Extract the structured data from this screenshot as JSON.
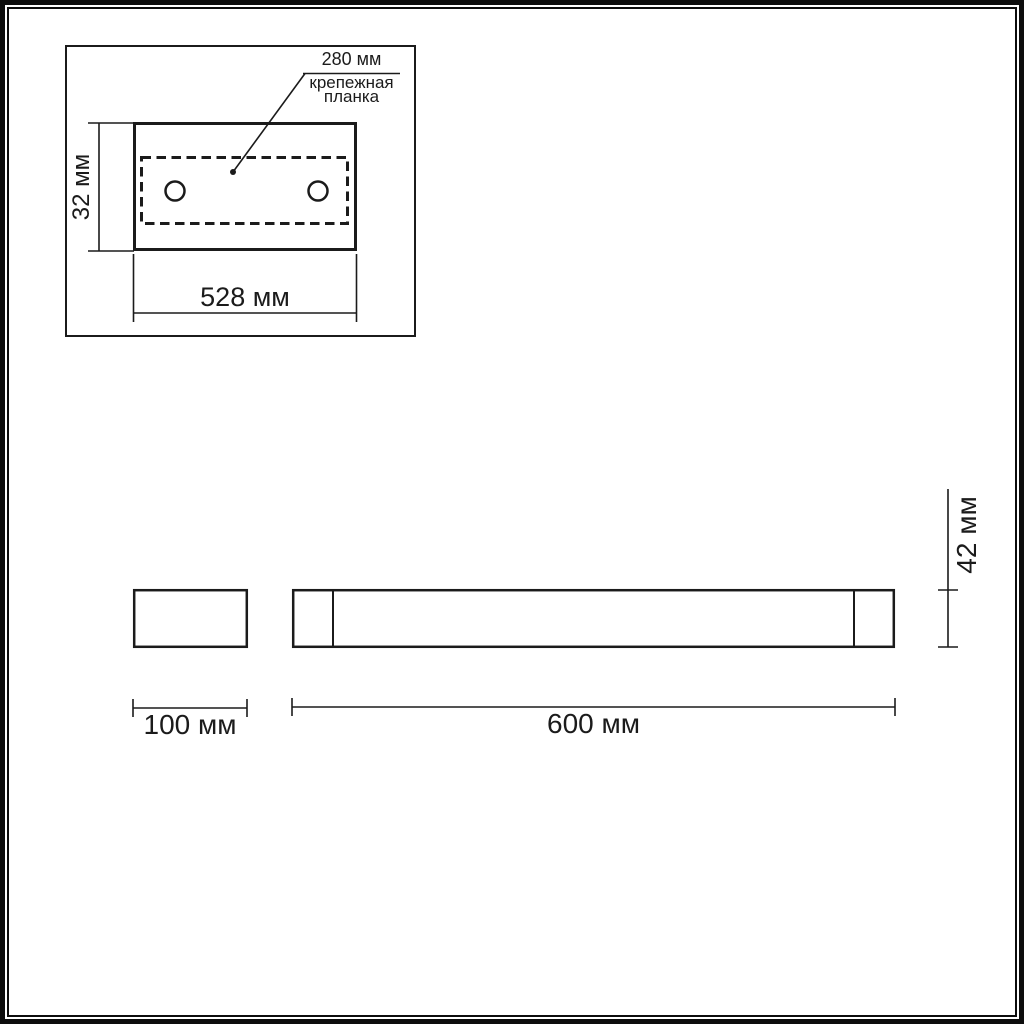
{
  "drawing": {
    "kind": "luminaire-dimension-drawing",
    "units": "мм",
    "line_color": "#1b1b1b",
    "background_color": "#ffffff",
    "top_view": {
      "bracket_length_label": "280 мм",
      "bracket_name_label": "крепежная\nпланка",
      "plate_height_label": "32 мм",
      "plate_width_label": "528 мм",
      "hole_count": 2
    },
    "front_view": {
      "length_label": "600 мм",
      "height_label": "42 мм"
    },
    "side_view": {
      "depth_label": "100 мм"
    }
  }
}
